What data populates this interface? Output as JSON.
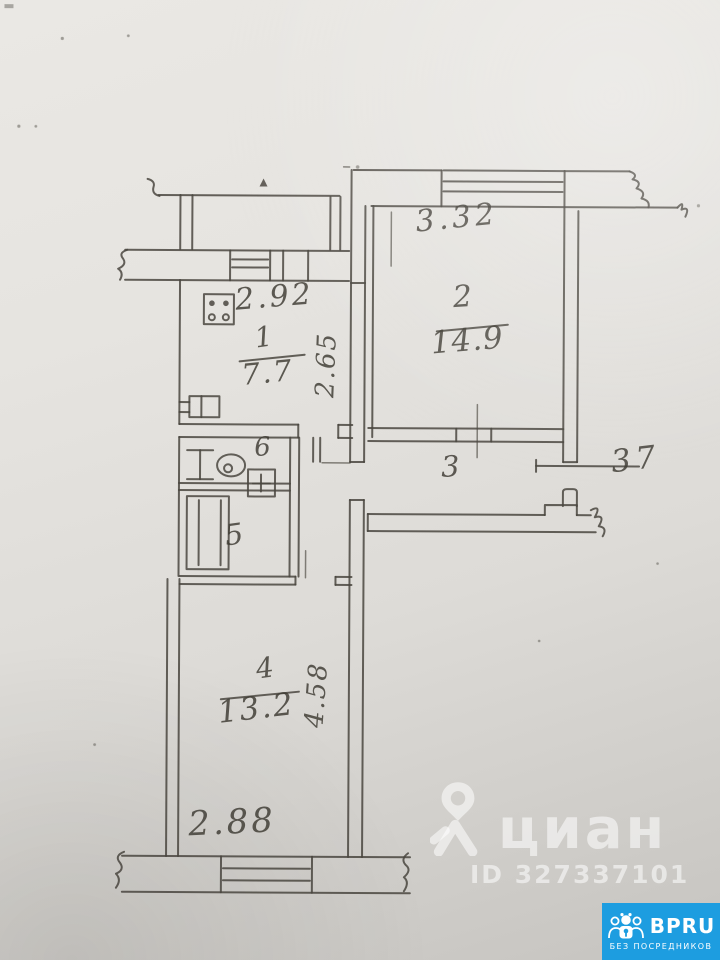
{
  "colors": {
    "paper": "#e6e4e0",
    "ink": "#4a473f",
    "badge_blue": "#1d9de0",
    "watermark_white": "rgba(255,255,255,0.55)"
  },
  "plan": {
    "rooms": [
      {
        "number": "1",
        "area": "7.7"
      },
      {
        "number": "2",
        "area": "14.9"
      },
      {
        "number": "3",
        "area": ""
      },
      {
        "number": "4",
        "area": "13.2"
      },
      {
        "number": "5",
        "area": ""
      },
      {
        "number": "6",
        "area": ""
      }
    ],
    "dimensions": {
      "kitchen_width": "2.92",
      "kitchen_depth": "2.65",
      "room2_width": "3.32",
      "hallway_area": "37",
      "room4_depth": "4.58",
      "room4_width": "2.88"
    }
  },
  "watermark": {
    "brand": "циан",
    "listing_id": "ID 327337101"
  },
  "badge": {
    "brand": "BPRU",
    "tagline": "БЕЗ ПОСРЕДНИКОВ"
  }
}
